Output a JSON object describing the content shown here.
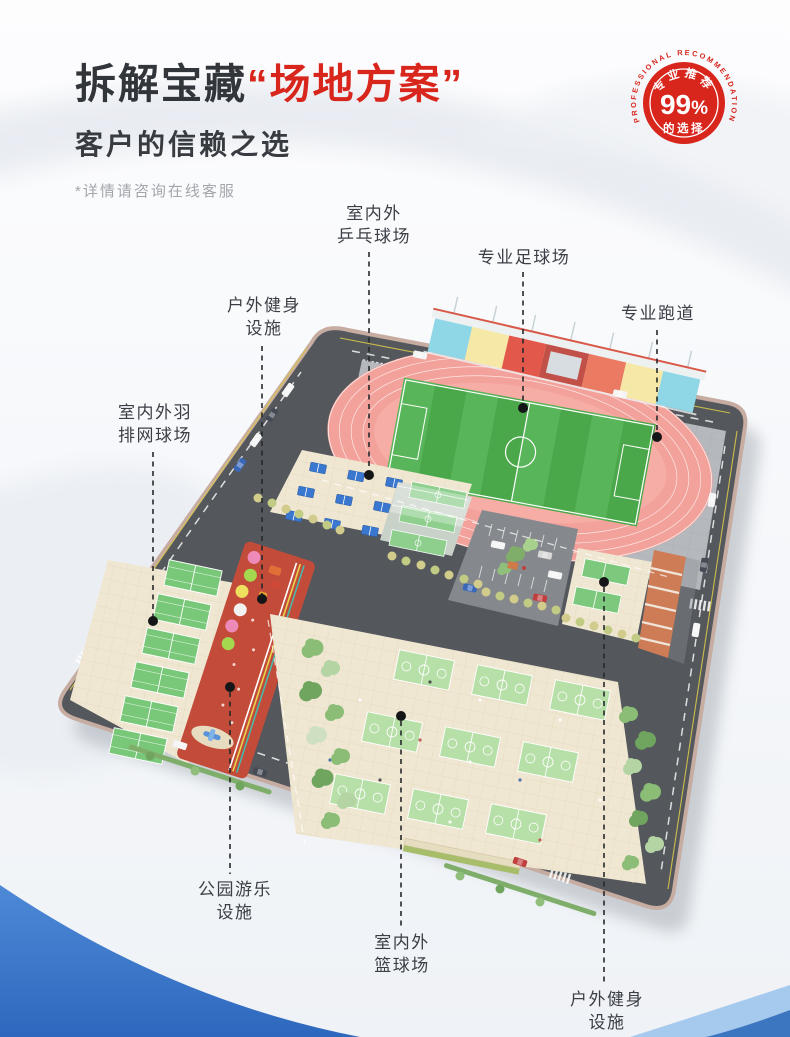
{
  "header": {
    "title_black": "拆解宝藏",
    "title_red": "“场地方案”",
    "subtitle": "客户的信赖之选",
    "note": "*详情请咨询在线客服"
  },
  "badge": {
    "ring_text": "PROFESSIONAL RECOMMENDATION",
    "top_text": "专业推荐",
    "big_number": "99",
    "percent_sign": "%",
    "bottom_text": "的选择"
  },
  "map": {
    "callouts": [
      {
        "id": "pingpong",
        "line1": "室内外",
        "line2": "乒乓球场"
      },
      {
        "id": "football",
        "line1": "专业足球场",
        "line2": ""
      },
      {
        "id": "track",
        "line1": "专业跑道",
        "line2": ""
      },
      {
        "id": "fitness-top",
        "line1": "户外健身",
        "line2": "设施"
      },
      {
        "id": "badminton",
        "line1": "室内外羽",
        "line2": "排网球场"
      },
      {
        "id": "park",
        "line1": "公园游乐",
        "line2": "设施"
      },
      {
        "id": "basketball",
        "line1": "室内外",
        "line2": "篮球场"
      },
      {
        "id": "fitness-bottom",
        "line1": "户外健身",
        "line2": "设施"
      }
    ]
  },
  "colors": {
    "accent_red": "#d8261d",
    "title_dark": "#32363b",
    "note_gray": "#a2a6ab",
    "label_dark": "#3b3f45",
    "wave_blue": "#2d68be",
    "wave_light_blue": "#a6c9ee",
    "road_gray": "#54585d",
    "ground_beige": "#f0e7d2",
    "track_pink": "#f2a29b",
    "field_green": "#4aa84a",
    "court_green": "#b7dfa8"
  }
}
